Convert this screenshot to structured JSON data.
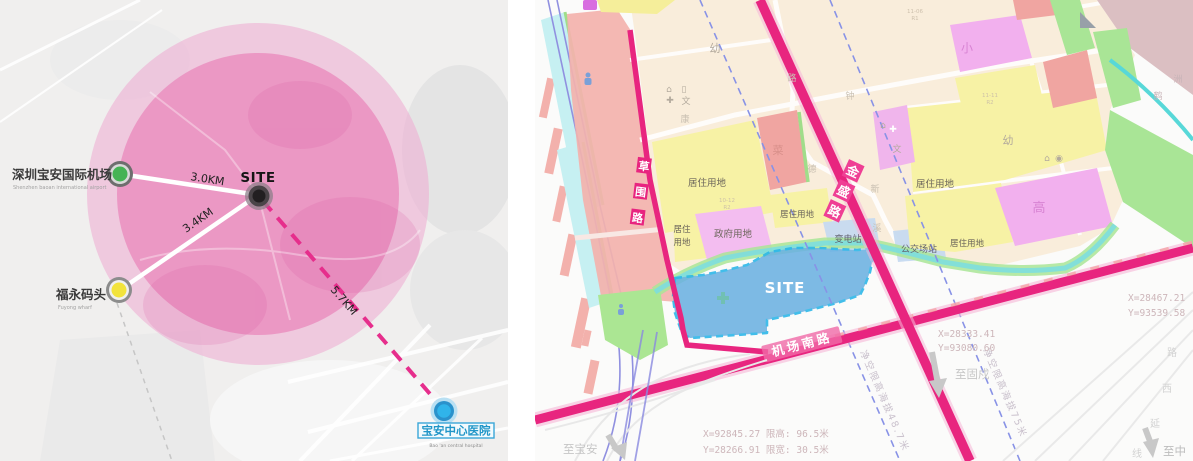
{
  "left": {
    "site": "SITE",
    "airport_zh": "深圳宝安国际机场",
    "airport_en": "Shenzhen baoan international airport",
    "wharf_zh": "福永码头",
    "wharf_en": "Fuyong  wharf",
    "hospital_zh": "宝安中心医院",
    "hospital_en": "Bao 'an central hospital",
    "d_airport": "3.0KM",
    "d_wharf": "3.4KM",
    "d_hospital": "5.7KM",
    "colors": {
      "radius_outer": "#eeaad2",
      "radius_inner": "#e87ab4",
      "dashed_line": "#e62e8c",
      "airport_dot": "#45b354",
      "wharf_dot": "#f2e33c",
      "hospital_dot": "#30b4ea"
    }
  },
  "right": {
    "site": "SITE",
    "road_caowei": [
      "草",
      "围",
      "路"
    ],
    "road_jinsheng": [
      "金",
      "盛",
      "路"
    ],
    "road_jichangnan": "机场南路",
    "residential": "居住用地",
    "res_l1": "居住",
    "res_l2": "用地",
    "government": "政府用地",
    "substation": "变电站",
    "bus_station": "公交场站",
    "kindergarten": "幼",
    "primary": "小",
    "high": "高",
    "market": "菜",
    "wen": "文",
    "clearance_487": "净空限高海拔48.7米",
    "clearance_75": "净空限高海拔75米",
    "to_gushu": "至固戍",
    "to_baoan": "至宝安",
    "to_zhong": "至中",
    "coord_ne_x": "X=28467.21",
    "coord_ne_y": "Y=93539.58",
    "coord_mid_x": "X=28333.41",
    "coord_mid_y": "Y=93080.60",
    "road_spec_x": "X=92845.27 限高: 96.5米",
    "road_spec_y": "Y=28266.91 限宽: 30.5米",
    "ext_chars": [
      "路",
      "西",
      "延",
      "线"
    ],
    "map_chars": {
      "kang": "康",
      "zhong": "钟",
      "de": "德",
      "xin": "新",
      "xi": "溪",
      "lu": "路",
      "he": "鹤",
      "zhou": "洲"
    },
    "codes": {
      "a": "11-06",
      "a2": "R1",
      "b": "11-11",
      "b2": "R2",
      "c": "10-12",
      "c2": "R2"
    },
    "colors": {
      "road_magenta": "#e8257f",
      "site_fill": "#6cb2e2",
      "site_border": "#29b6e8",
      "residential_yellow": "#f7f2a5",
      "government_pink": "#f3bdf0",
      "village_salmon": "#f3b2ad",
      "green": "#abe693",
      "water_cyan": "#7adde2"
    }
  }
}
